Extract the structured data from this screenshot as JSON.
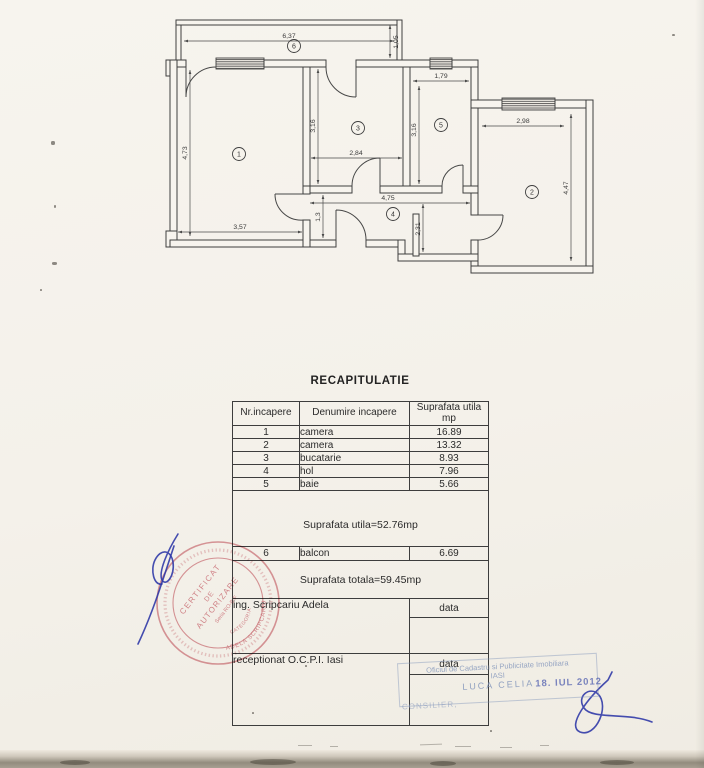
{
  "document": {
    "title": "RECAPITULATIE"
  },
  "plan": {
    "room_labels": {
      "r1": "1",
      "r2": "2",
      "r3": "3",
      "r4": "4",
      "r5": "5",
      "r6": "6"
    },
    "dims": {
      "balcony_w": "6,37",
      "balcony_d": "1,05",
      "room1_h": "4,73",
      "room1_w": "3,57",
      "room3_h": "3,16",
      "room3_w": "2,84",
      "room5_w": "1,79",
      "room5_h": "3,16",
      "room2_w": "2,98",
      "room2_h": "4,47",
      "hall_w": "4,75",
      "hall_d": "1,3",
      "vest_d": "2,31"
    }
  },
  "table": {
    "headers": {
      "col1": "Nr.incapere",
      "col2": "Denumire incapere",
      "col3_line1": "Suprafata utila",
      "col3_line2": "mp"
    },
    "rows": [
      {
        "nr": "1",
        "name": "camera",
        "area": "16.89"
      },
      {
        "nr": "2",
        "name": "camera",
        "area": "13.32"
      },
      {
        "nr": "3",
        "name": "bucatarie",
        "area": "8.93"
      },
      {
        "nr": "4",
        "name": "hol",
        "area": "7.96"
      },
      {
        "nr": "5",
        "name": "baie",
        "area": "5.66"
      }
    ],
    "subtotal": "Suprafata utila=52.76mp",
    "balcony_row": {
      "nr": "6",
      "name": "balcon",
      "area": "6.69"
    },
    "total": "Suprafata totala=59.45mp",
    "engineer": "ing. Scripcariu Adela",
    "date_label_1": "data",
    "reception": "receptionat O.C.P.I. Iasi",
    "date_label_2": "data"
  },
  "stamps": {
    "round": {
      "line1": "CERTIFICAT",
      "line2": "DE",
      "line3": "AUTORIZARE",
      "line4": "Seria RO-B-F",
      "name": "ADELA SCRIPCARIU",
      "category": "CATEGORIA"
    },
    "office": {
      "line1": "Oficiul de Cadastru si Publicitate Imobiliara",
      "line2": "IASI",
      "name": "LUCA CELIA",
      "date": "18. IUL 2012",
      "role": "CONSILIER,"
    }
  },
  "colors": {
    "paper": "#f5f2ec",
    "ink": "#2f2f2f",
    "stamp_red": "#cf6b76",
    "stamp_blue": "#8094ba",
    "signature_blue": "#2b35a6"
  }
}
